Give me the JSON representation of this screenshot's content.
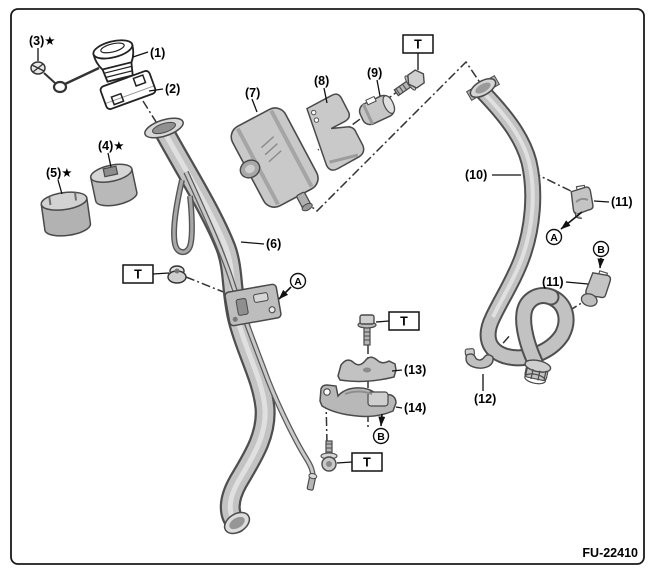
{
  "figure": {
    "code": "FU-22410"
  },
  "torque": {
    "label": "T"
  },
  "refs": {
    "a": "A",
    "b": "B"
  },
  "parts": {
    "p1": "(1)",
    "p2": "(2)",
    "p3": "(3)★",
    "p4": "(4)★",
    "p5": "(5)★",
    "p6": "(6)",
    "p7": "(7)",
    "p8": "(8)",
    "p9": "(9)",
    "p10": "(10)",
    "p11": "(11)",
    "p12": "(12)",
    "p13": "(13)",
    "p14": "(14)"
  }
}
